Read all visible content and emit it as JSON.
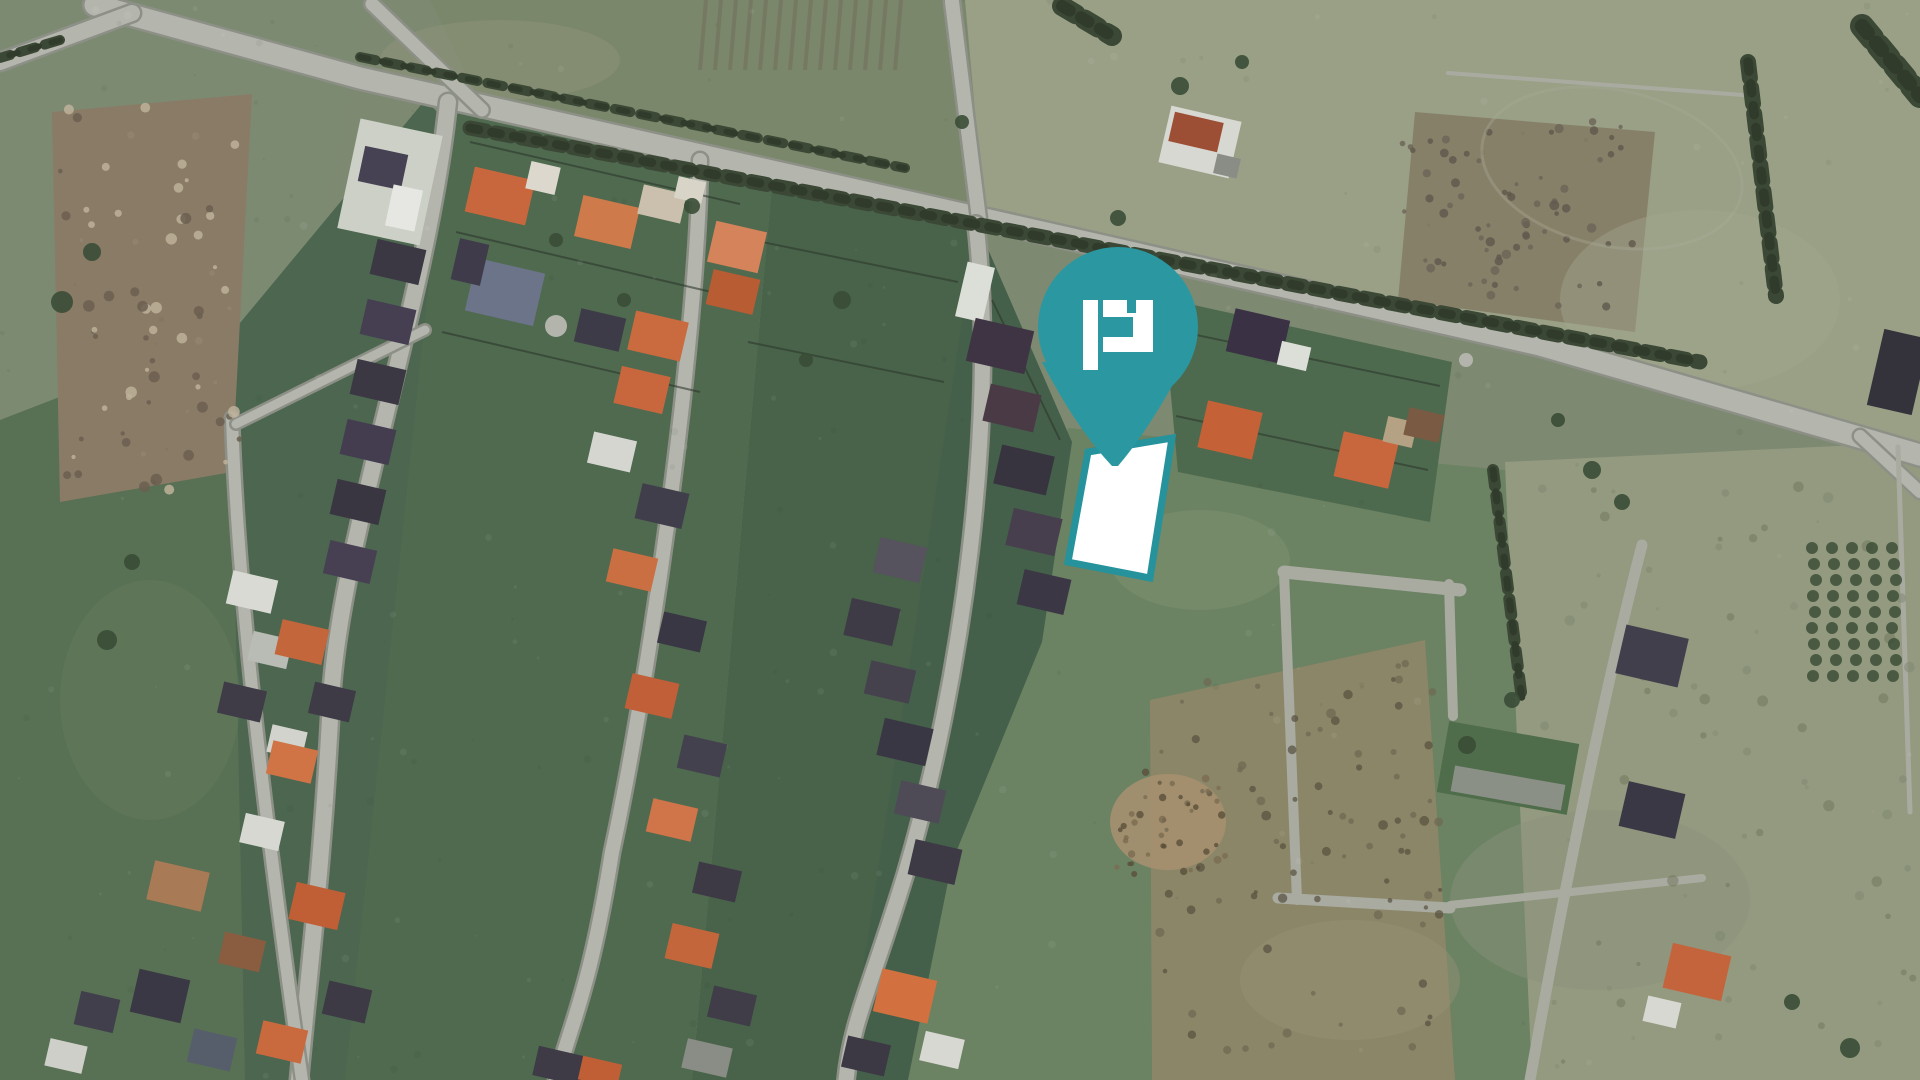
{
  "scene": {
    "width": 1920,
    "height": 1080,
    "background": "#7e8972",
    "palette": {
      "road": "#b4b6ae",
      "road_casing": "#8d9086",
      "lane": "#a9aba1",
      "hedge": "#3c4836",
      "hedge_dark": "#313b2b",
      "fence": "#2e382d",
      "tree": "#3a4c36",
      "pin_teal": "#2b98a1",
      "parcel_border_teal": "#25929c",
      "parcel_fill": "#ffffff"
    },
    "marker": {
      "label": "property-location-pin",
      "cx": 1118,
      "cy": 327,
      "r": 80,
      "tail": "M1042,362 Q1076,428 1112,466 L1118,466 Q1152,426 1186,360 Z",
      "color": "#2b98a1",
      "logo": {
        "label": "p-logo",
        "color": "#ffffff",
        "bars": [
          [
            1083,
            300,
            15,
            70
          ],
          [
            1103,
            300,
            50,
            52
          ]
        ],
        "cutouts": [
          [
            1127,
            300,
            9,
            13
          ],
          [
            1103,
            317,
            30,
            20
          ]
        ]
      }
    },
    "parcel": {
      "label": "highlighted-parcel",
      "points": "1088,452 1172,438 1150,578 1068,562",
      "fill": "#ffffff",
      "stroke": "#25929c",
      "stroke_width": 7
    },
    "fields": [
      {
        "points": "0,0 370,0 300,335 0,425",
        "fill": "#7d8a72"
      },
      {
        "points": "430,0 965,0 980,220 485,112",
        "fill": "#7a876b"
      },
      {
        "points": "965,0 1920,0 1920,445 985,222",
        "fill": "#99a086"
      },
      {
        "points": "1415,112 1655,132 1635,332 1398,300",
        "fill": "#878069"
      },
      {
        "points": "0,420 238,328 345,1080 0,1080",
        "fill": "#587053"
      },
      {
        "points": "230,335 425,100 478,152 432,740 352,1080 245,1080",
        "fill": "#4c6650"
      },
      {
        "points": "1068,428 1505,470 1532,1080 866,1080 932,838 1000,630",
        "fill": "#6b8263"
      },
      {
        "points": "1505,462 1920,442 1920,1080 1532,1080",
        "fill": "#939a80"
      },
      {
        "points": "1150,700 1425,640 1455,1080 1152,1080",
        "fill": "#8b8668"
      },
      {
        "points": "52,112 252,94 232,472 60,502",
        "fill": "#8a7b66"
      }
    ],
    "mottles": [
      {
        "cx": 1200,
        "cy": 560,
        "rx": 90,
        "ry": 50,
        "fill": "#7e9270",
        "op": 0.5
      },
      {
        "cx": 1350,
        "cy": 980,
        "rx": 110,
        "ry": 60,
        "fill": "#9a9478",
        "op": 0.4
      },
      {
        "cx": 1700,
        "cy": 300,
        "rx": 140,
        "ry": 90,
        "fill": "#a3a88e",
        "op": 0.4
      },
      {
        "cx": 500,
        "cy": 60,
        "rx": 120,
        "ry": 40,
        "fill": "#8d9478",
        "op": 0.5
      },
      {
        "cx": 150,
        "cy": 700,
        "rx": 90,
        "ry": 120,
        "fill": "#6a8060",
        "op": 0.4
      },
      {
        "cx": 1600,
        "cy": 900,
        "rx": 150,
        "ry": 90,
        "fill": "#8b9379",
        "op": 0.45
      },
      {
        "cx": 1168,
        "cy": 822,
        "rx": 58,
        "ry": 48,
        "fill": "#a5906f",
        "op": 0.9
      }
    ],
    "blocks": [
      {
        "points": "447,108 772,184 692,1080 345,1080",
        "fill": "#4f6a4f"
      },
      {
        "points": "772,184 977,224 902,1080 692,1080",
        "fill": "#486349"
      },
      {
        "points": "977,224 1072,442 1042,642 952,862 908,1080 846,1080",
        "fill": "#44604a"
      },
      {
        "points": "1162,298 1452,362 1430,522 1178,472",
        "fill": "#4e6a4e"
      }
    ],
    "stripes": {
      "x": 700,
      "y": 0,
      "w": 210,
      "h": 70,
      "n": 14,
      "color": "#6f6a57",
      "op": 0.45,
      "slant": 6
    },
    "roads": [
      {
        "d": "M95,5 L360,78 L980,218 L1540,345 L1862,438 L1920,455",
        "w": 21
      },
      {
        "d": "M0,62 L132,13",
        "w": 16
      },
      {
        "d": "M372,4 L482,110",
        "w": 13
      },
      {
        "d": "M952,2 L979,219",
        "w": 14
      },
      {
        "d": "M448,102 C428,300 340,540 331,700 C323,860 310,960 299,1080",
        "w": 16
      },
      {
        "d": "M700,160 C697,360 645,700 612,852 C590,990 572,1020 556,1080",
        "w": 14
      },
      {
        "d": "M976,224 C998,420 962,680 906,872 C870,990 852,1020 846,1080",
        "w": 15
      },
      {
        "d": "M232,418 C238,600 265,820 302,1080",
        "w": 12
      },
      {
        "d": "M425,330 L236,424",
        "w": 9
      },
      {
        "d": "M1860,436 L1920,492",
        "w": 12
      }
    ],
    "lanes": [
      {
        "d": "M1284,572 L1460,590",
        "w": 13
      },
      {
        "d": "M1284,572 L1297,900",
        "w": 10
      },
      {
        "d": "M1449,584 L1453,716",
        "w": 10
      },
      {
        "d": "M1278,898 L1450,908",
        "w": 11
      },
      {
        "d": "M1450,905 L1702,878",
        "w": 8
      },
      {
        "d": "M1642,545 C1602,700 1562,900 1530,1080",
        "w": 11
      },
      {
        "d": "M1898,447 L1910,812",
        "w": 5
      },
      {
        "d": "M1448,73 L1756,96",
        "w": 4
      }
    ],
    "hedges": [
      {
        "d": "M470,128 L1700,362",
        "w": 15
      },
      {
        "d": "M360,57 L905,168",
        "w": 10
      },
      {
        "d": "M1748,62 L1776,296",
        "w": 16
      },
      {
        "d": "M1493,470 L1522,700",
        "w": 12
      },
      {
        "d": "M1862,26 L1920,96",
        "w": 24
      },
      {
        "d": "M1062,6 L1112,36",
        "w": 20
      },
      {
        "d": "M60,40 L0,58",
        "w": 10
      }
    ],
    "fences": [
      [
        470,
        142,
        740,
        204
      ],
      [
        456,
        232,
        720,
        294
      ],
      [
        442,
        332,
        700,
        392
      ],
      [
        762,
        242,
        958,
        282
      ],
      [
        748,
        342,
        944,
        382
      ],
      [
        1182,
        332,
        1440,
        386
      ],
      [
        1176,
        416,
        1428,
        470
      ],
      [
        992,
        300,
        1060,
        440
      ]
    ],
    "houses": [
      [
        390,
        182,
        84,
        112,
        12,
        "#ccd0c6"
      ],
      [
        383,
        168,
        44,
        36,
        12,
        "#474253"
      ],
      [
        404,
        208,
        30,
        42,
        12,
        "#e6e7e2"
      ],
      [
        500,
        196,
        62,
        46,
        13,
        "#c8673d"
      ],
      [
        543,
        178,
        30,
        28,
        13,
        "#dcd8ce"
      ],
      [
        607,
        222,
        58,
        42,
        13,
        "#cf7a4a"
      ],
      [
        662,
        204,
        44,
        30,
        13,
        "#cbc0ad"
      ],
      [
        737,
        247,
        52,
        42,
        13,
        "#d4835a"
      ],
      [
        733,
        292,
        48,
        36,
        13,
        "#b85c34"
      ],
      [
        658,
        336,
        54,
        40,
        13,
        "#c96a3f"
      ],
      [
        690,
        190,
        28,
        22,
        13,
        "#d8d4c8"
      ],
      [
        505,
        292,
        70,
        54,
        13,
        "#6b7488"
      ],
      [
        470,
        262,
        30,
        42,
        13,
        "#3f3b4a"
      ],
      [
        398,
        262,
        50,
        36,
        13,
        "#3b3844"
      ],
      [
        388,
        322,
        50,
        36,
        13,
        "#463f52"
      ],
      [
        378,
        382,
        50,
        36,
        13,
        "#3b3844"
      ],
      [
        368,
        442,
        50,
        36,
        13,
        "#443d4f"
      ],
      [
        358,
        502,
        50,
        36,
        13,
        "#393641"
      ],
      [
        350,
        562,
        48,
        34,
        13,
        "#474052"
      ],
      [
        252,
        592,
        46,
        34,
        13,
        "#d9dad4"
      ],
      [
        270,
        650,
        40,
        30,
        13,
        "#b9bcb4"
      ],
      [
        242,
        702,
        44,
        32,
        13,
        "#3f3c48"
      ],
      [
        287,
        742,
        36,
        28,
        13,
        "#d3d3cd"
      ],
      [
        178,
        886,
        56,
        40,
        13,
        "#a87a55"
      ],
      [
        160,
        996,
        52,
        44,
        13,
        "#3a3844"
      ],
      [
        212,
        1050,
        44,
        34,
        13,
        "#565e6b"
      ],
      [
        97,
        1012,
        40,
        34,
        13,
        "#413f4b"
      ],
      [
        66,
        1056,
        38,
        28,
        13,
        "#cfcfc9"
      ],
      [
        302,
        642,
        48,
        36,
        13,
        "#c4663c"
      ],
      [
        332,
        702,
        42,
        32,
        13,
        "#3e3b47"
      ],
      [
        292,
        762,
        46,
        34,
        13,
        "#d07446"
      ],
      [
        262,
        832,
        40,
        30,
        13,
        "#d8d8d2"
      ],
      [
        317,
        906,
        50,
        38,
        13,
        "#c05f36"
      ],
      [
        242,
        952,
        42,
        32,
        13,
        "#8a5d40"
      ],
      [
        347,
        1002,
        44,
        34,
        13,
        "#3d3a46"
      ],
      [
        282,
        1042,
        46,
        34,
        13,
        "#c96a3e"
      ],
      [
        600,
        330,
        46,
        34,
        13,
        "#3e3b48"
      ],
      [
        642,
        390,
        50,
        38,
        13,
        "#c8673d"
      ],
      [
        612,
        452,
        44,
        32,
        13,
        "#d6d6d0"
      ],
      [
        662,
        506,
        48,
        36,
        13,
        "#413e4b"
      ],
      [
        632,
        570,
        46,
        34,
        13,
        "#ca6f42"
      ],
      [
        682,
        632,
        44,
        32,
        13,
        "#3a3745"
      ],
      [
        652,
        696,
        48,
        36,
        13,
        "#c05f38"
      ],
      [
        702,
        756,
        44,
        34,
        13,
        "#44414e"
      ],
      [
        672,
        820,
        46,
        34,
        13,
        "#d0744a"
      ],
      [
        717,
        882,
        44,
        32,
        13,
        "#3d3a46"
      ],
      [
        692,
        946,
        48,
        36,
        13,
        "#c4663c"
      ],
      [
        732,
        1006,
        44,
        32,
        13,
        "#403d49"
      ],
      [
        707,
        1058,
        46,
        30,
        13,
        "#8a8c86"
      ],
      [
        975,
        292,
        28,
        56,
        13,
        "#dcded8"
      ],
      [
        1000,
        346,
        60,
        44,
        13,
        "#3f3443"
      ],
      [
        1012,
        408,
        52,
        38,
        13,
        "#4a3a46"
      ],
      [
        1024,
        470,
        54,
        40,
        13,
        "#38343f"
      ],
      [
        1034,
        532,
        50,
        38,
        13,
        "#473f4e"
      ],
      [
        1044,
        592,
        48,
        36,
        13,
        "#3b3744"
      ],
      [
        900,
        560,
        48,
        36,
        13,
        "#56525e"
      ],
      [
        872,
        622,
        50,
        38,
        13,
        "#3e3b47"
      ],
      [
        890,
        682,
        46,
        34,
        13,
        "#45424e"
      ],
      [
        905,
        742,
        50,
        38,
        13,
        "#3a3744"
      ],
      [
        920,
        802,
        46,
        34,
        13,
        "#4e4a56"
      ],
      [
        935,
        862,
        48,
        36,
        13,
        "#3d3a46"
      ],
      [
        905,
        996,
        56,
        44,
        13,
        "#d2713f"
      ],
      [
        942,
        1050,
        40,
        30,
        13,
        "#d8d8d2"
      ],
      [
        866,
        1056,
        44,
        32,
        13,
        "#3c3945"
      ],
      [
        1258,
        336,
        56,
        44,
        13,
        "#3a3145"
      ],
      [
        1294,
        356,
        30,
        24,
        13,
        "#dcded8"
      ],
      [
        1230,
        430,
        56,
        48,
        13,
        "#c46136"
      ],
      [
        1366,
        460,
        56,
        46,
        13,
        "#c8673d"
      ],
      [
        1400,
        432,
        30,
        26,
        13,
        "#b5a284"
      ],
      [
        1424,
        425,
        36,
        28,
        13,
        "#7a5a42"
      ],
      [
        1200,
        142,
        72,
        58,
        13,
        "#d8d8d2"
      ],
      [
        1196,
        132,
        50,
        30,
        13,
        "#9c4f35"
      ],
      [
        1227,
        166,
        24,
        20,
        13,
        "#8a8c86"
      ],
      [
        1652,
        656,
        64,
        50,
        13,
        "#423f4c"
      ],
      [
        1652,
        810,
        58,
        46,
        13,
        "#3a3845"
      ],
      [
        1697,
        972,
        60,
        46,
        13,
        "#c4643c"
      ],
      [
        1662,
        1012,
        34,
        26,
        13,
        "#d8d8d2"
      ],
      [
        1898,
        372,
        46,
        78,
        13,
        "#34333c"
      ],
      [
        1508,
        768,
        132,
        72,
        10,
        "#4f6d4a"
      ],
      [
        1508,
        788,
        112,
        26,
        10,
        "#8b9086"
      ],
      [
        560,
        1066,
        50,
        30,
        13,
        "#3e3b47"
      ],
      [
        600,
        1072,
        40,
        24,
        13,
        "#c05f36"
      ]
    ],
    "trees": [
      [
        692,
        206,
        8
      ],
      [
        624,
        300,
        7
      ],
      [
        842,
        300,
        9
      ],
      [
        1180,
        86,
        9
      ],
      [
        1242,
        62,
        7
      ],
      [
        962,
        122,
        7
      ],
      [
        1592,
        470,
        9
      ],
      [
        1622,
        502,
        8
      ],
      [
        107,
        640,
        10
      ],
      [
        132,
        562,
        8
      ],
      [
        62,
        302,
        11
      ],
      [
        92,
        252,
        9
      ],
      [
        1850,
        1048,
        10
      ],
      [
        1792,
        1002,
        8
      ],
      [
        1467,
        745,
        9
      ],
      [
        1512,
        700,
        8
      ],
      [
        556,
        240,
        7
      ],
      [
        806,
        360,
        7
      ],
      [
        1118,
        218,
        8
      ],
      [
        1558,
        420,
        7
      ]
    ],
    "tree_rows": {
      "x0": 1812,
      "y0": 548,
      "cols": 5,
      "rows": 9,
      "dx": 20,
      "dy": 16,
      "r": 6,
      "fill": "#3d4f37"
    },
    "dots": [
      {
        "cx": 556,
        "cy": 326,
        "r": 11,
        "fill": "#b3b5ad"
      },
      {
        "cx": 1466,
        "cy": 360,
        "r": 7,
        "fill": "#b3b5ad"
      }
    ],
    "arcs": [
      {
        "cx": 1612,
        "cy": 168,
        "rx": 132,
        "ry": 78,
        "rot": 12,
        "stroke": "#a9ad98",
        "w": 3,
        "op": 0.35
      }
    ],
    "speckle_areas": [
      {
        "x": 1400,
        "y": 115,
        "w": 240,
        "h": 200,
        "n": 70,
        "colors": [
          "#5f584c",
          "#6b6355"
        ],
        "rmin": 2,
        "rmax": 5,
        "op": 0.8
      },
      {
        "x": 1155,
        "y": 660,
        "w": 290,
        "h": 390,
        "n": 85,
        "colors": [
          "#6e6751",
          "#57503f"
        ],
        "rmin": 2,
        "rmax": 5,
        "op": 0.7
      },
      {
        "x": 1115,
        "y": 768,
        "w": 110,
        "h": 110,
        "n": 40,
        "colors": [
          "#5a4f3a",
          "#7a6c50"
        ],
        "rmin": 2,
        "rmax": 4,
        "op": 0.8
      },
      {
        "x": 55,
        "y": 100,
        "w": 185,
        "h": 390,
        "n": 60,
        "colors": [
          "#6b5f50",
          "#bdb29a"
        ],
        "rmin": 2,
        "rmax": 6,
        "op": 0.85
      },
      {
        "x": 1530,
        "y": 450,
        "w": 390,
        "h": 620,
        "n": 60,
        "colors": [
          "#7f8670",
          "#6d7458"
        ],
        "rmin": 2,
        "rmax": 6,
        "op": 0.5
      },
      {
        "x": 0,
        "y": 0,
        "w": 1920,
        "h": 1080,
        "n": 240,
        "colors": [
          "#ffffff",
          "#242e22"
        ],
        "rmin": 1,
        "rmax": 4,
        "op": 0.06
      }
    ]
  }
}
